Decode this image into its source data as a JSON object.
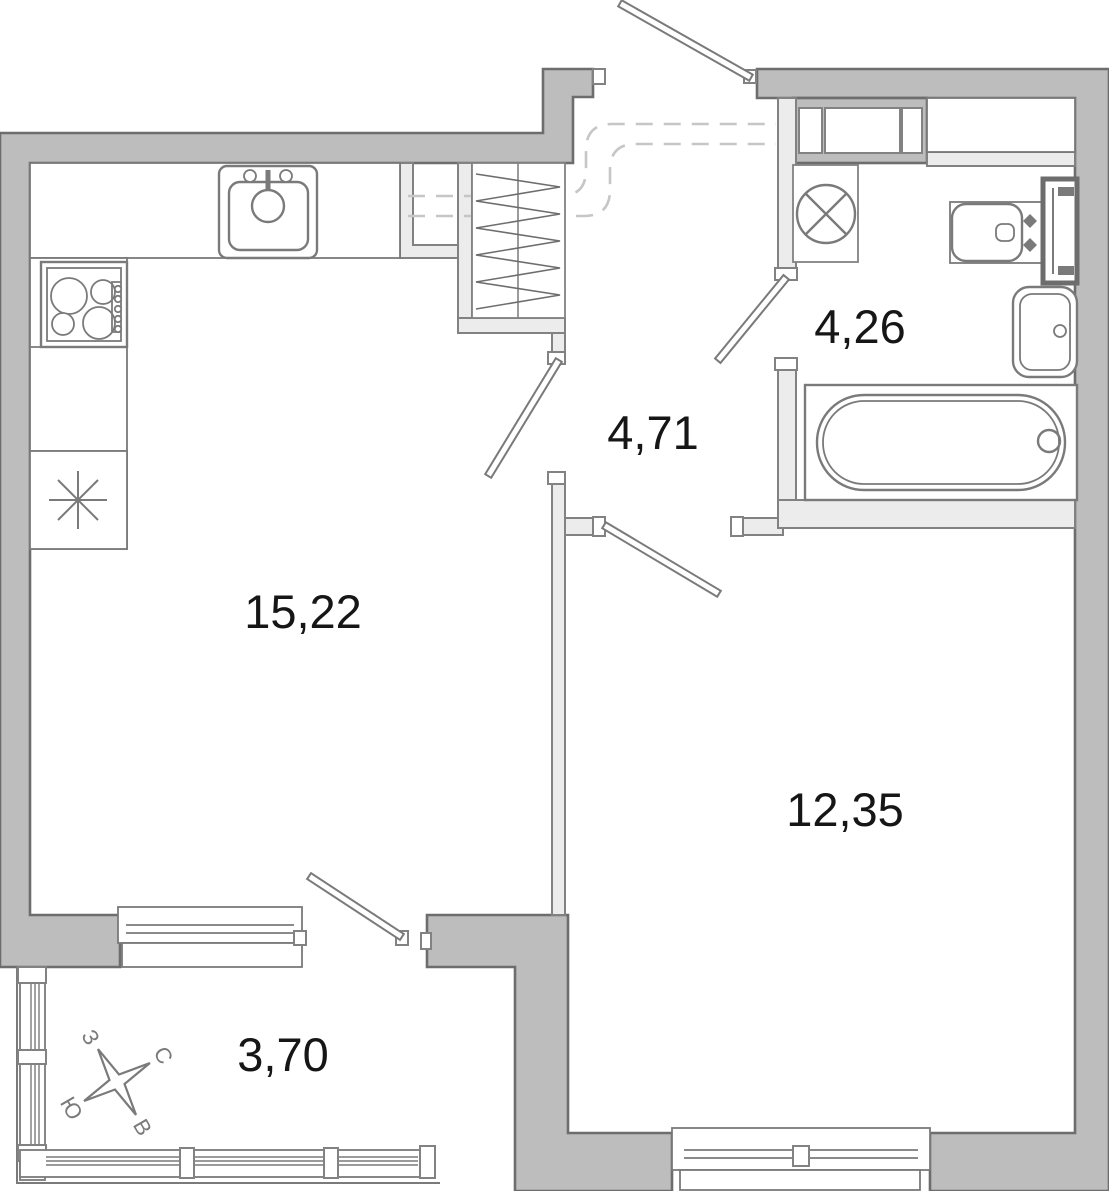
{
  "plan": {
    "rooms": {
      "living": {
        "area": "15,22"
      },
      "hallway": {
        "area": "4,71"
      },
      "bathroom": {
        "area": "4,26"
      },
      "bedroom": {
        "area": "12,35"
      },
      "balcony": {
        "area": "3,70"
      }
    },
    "compass": {
      "north": "С",
      "east": "В",
      "south": "Ю",
      "west": "З"
    },
    "fixtures": [
      "kitchen-sink",
      "stove",
      "refrigerator",
      "wardrobe",
      "washing-machine",
      "washbasin",
      "towel-radiator",
      "toilet",
      "bathtub",
      "bathroom-counter"
    ]
  },
  "palette": {
    "wall": "#bdbdbd",
    "wall-line": "#6d6d6d",
    "part": "#ececec",
    "part-line": "#828282",
    "fix": "#7a7a7a",
    "dash": "#c6c6c6",
    "ink": "#161616"
  }
}
